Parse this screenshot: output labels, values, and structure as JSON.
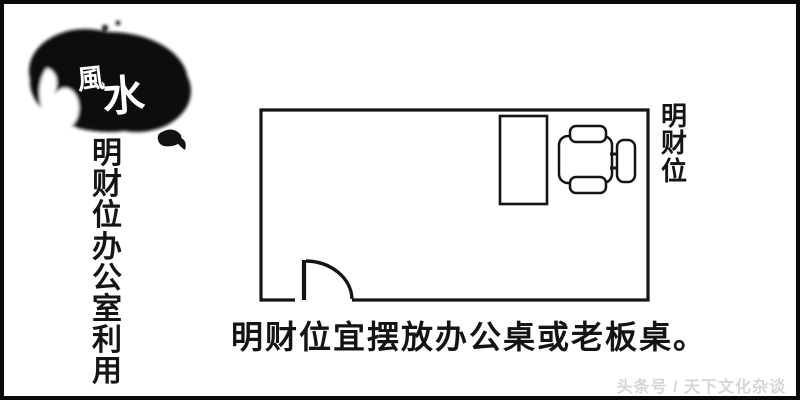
{
  "canvas": {
    "background": "#ffffff",
    "frame_color": "#0a0a0a",
    "line_color": "#141414"
  },
  "logo": {
    "char_top": "風",
    "char_bottom": "水",
    "ink_color": "#0f0f0f",
    "calligraphy_color": "#ffffff"
  },
  "left_title": {
    "text": "明财位办公室利用",
    "color": "#151515"
  },
  "floor_plan": {
    "label": "明财位",
    "wall_color": "#141414",
    "furniture_fill": "#ffffff"
  },
  "caption": {
    "text": "明财位宜摆放办公桌或老板桌。",
    "color": "#141414"
  },
  "watermark": {
    "text": "头条号 / 天下文化杂谈",
    "color": "#d6d6d6"
  }
}
